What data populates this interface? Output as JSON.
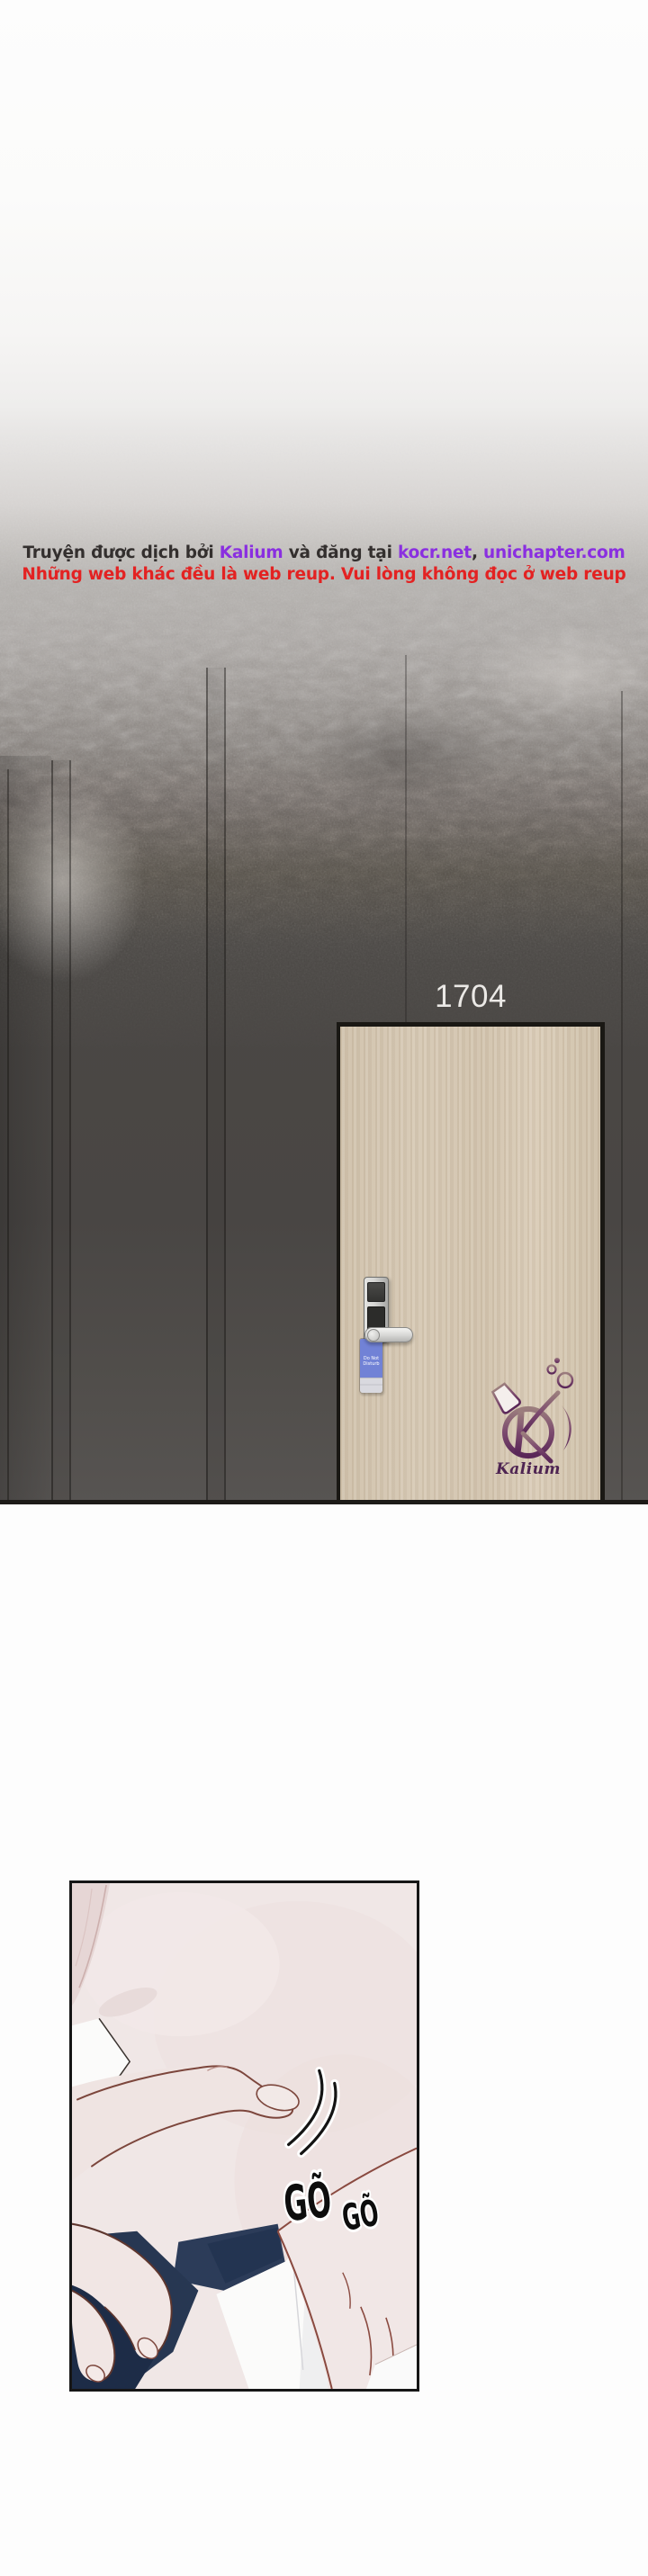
{
  "credits": {
    "line1": [
      {
        "text": "Truyện được dịch bởi ",
        "color": "dark"
      },
      {
        "text": "Kalium",
        "color": "purple"
      },
      {
        "text": " và đăng tại ",
        "color": "dark"
      },
      {
        "text": "kocr.net",
        "color": "purple"
      },
      {
        "text": ", ",
        "color": "dark"
      },
      {
        "text": "unichapter.com",
        "color": "purple"
      }
    ],
    "line2": "Những web khác đều là web reup. Vui lòng không đọc ở web reup"
  },
  "hallway": {
    "room_number": "1704",
    "door_tag": {
      "line1": "Do Not",
      "line2": "Disturb"
    }
  },
  "logo": {
    "brand": "Kalium"
  },
  "panel": {
    "sfx_large": "GÕ",
    "sfx_small": "GÕ"
  },
  "colors": {
    "credit_dark": "#332f2e",
    "credit_purple": "#8a2fe0",
    "credit_red": "#e32222",
    "room_number": "#ebe9e6",
    "wall_dark": "#4a4745",
    "wall_bottom": "#575452",
    "door_beige": "#d5c8b3",
    "door_frame": "#1a1814",
    "lock_silver": "#d6d6d4",
    "tag_blue": "#7182d6",
    "logo_purple_dark": "#5a2758",
    "logo_purple_light": "#9b7d7d",
    "panel_skin": "#f0e7e6",
    "panel_navy": "#2c3c59",
    "panel_outline": "#7c463c",
    "sfx_black": "#0d0d0d",
    "floor_line": "#1d1b18"
  }
}
